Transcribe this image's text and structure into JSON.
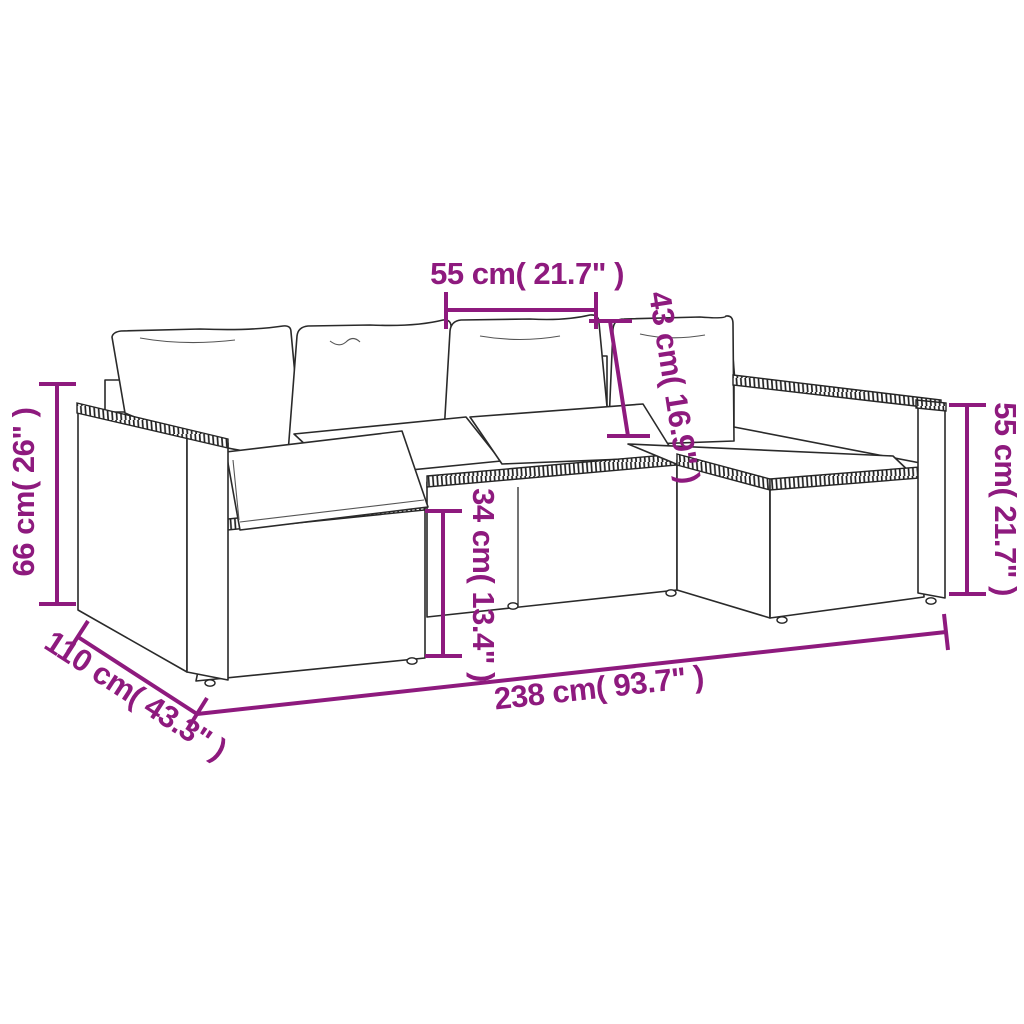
{
  "diagram": {
    "subject": "Poly rattan garden lounge set with cushions - dimension line drawing",
    "background_color": "#ffffff",
    "annotation_color": "#8E1A7E",
    "line_art_color": "#2a2a2a",
    "dimensions": {
      "seat_width": "55 cm( 21.7\" )",
      "backrest_height": "43 cm( 16.9\" )",
      "left_armrest_height": "66 cm( 26\" )",
      "seat_height": "34 cm( 13.4\" )",
      "right_armrest_height": "55 cm( 21.7\" )",
      "depth": "110 cm( 43.3\" )",
      "total_width": "238 cm( 93.7\" )"
    }
  }
}
